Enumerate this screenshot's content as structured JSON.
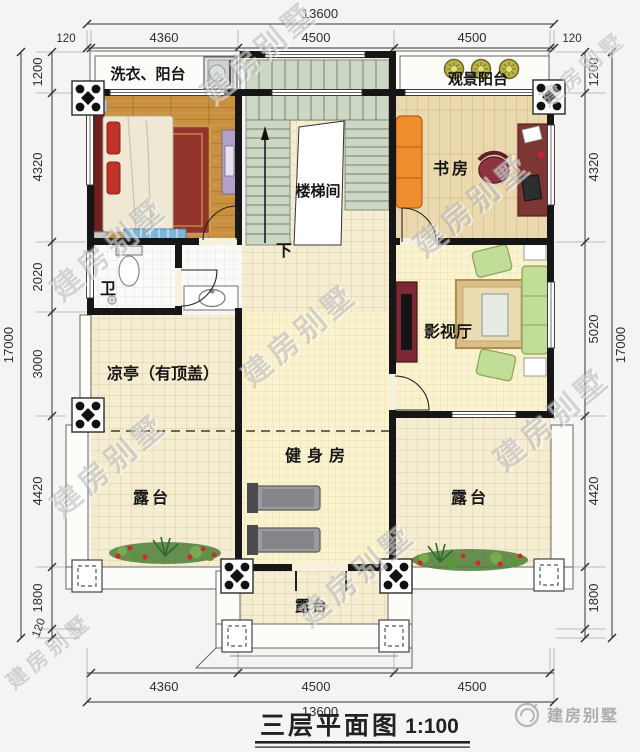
{
  "title_block": {
    "title": "三层平面图",
    "scale": "1:100"
  },
  "brand": {
    "name": "建房别墅",
    "watermark": "建房别墅"
  },
  "rooms": {
    "laundry_balcony": "洗衣、阳台",
    "view_balcony": "观景阳台",
    "study": "书房",
    "stairwell": "楼梯间",
    "stair_down": "下",
    "bathroom": "卫",
    "media_room": "影视厅",
    "pavilion": "凉亭（有顶盖）",
    "gym": "健身房",
    "terrace_left": "露台",
    "terrace_right": "露台",
    "terrace_bottom": "露台"
  },
  "dimensions": {
    "top": {
      "overall": "13600",
      "segments": [
        "120",
        "4360",
        "4500",
        "4500",
        "120"
      ]
    },
    "bottom": {
      "overall": "13600",
      "segments": [
        "4360",
        "4500",
        "4500"
      ]
    },
    "left": {
      "overall": "17000",
      "segments": [
        "1200",
        "4320",
        "2020",
        "3000",
        "4420",
        "1800",
        "120"
      ]
    },
    "right": {
      "overall": "17000",
      "segments": [
        "1200",
        "4320",
        "5020",
        "4420",
        "1800"
      ]
    }
  },
  "colors": {
    "wall": "#161616",
    "wood_floor": "#c8903f",
    "study_floor": "#ead9ae",
    "tile_cream": "#f5edd2",
    "grid_yellow": "#faf3d0",
    "stair": "#cdd7c5",
    "accent_sofa": "#ef8c2e",
    "accent_green": "#c2dd96",
    "accent_red": "#7c2836"
  }
}
